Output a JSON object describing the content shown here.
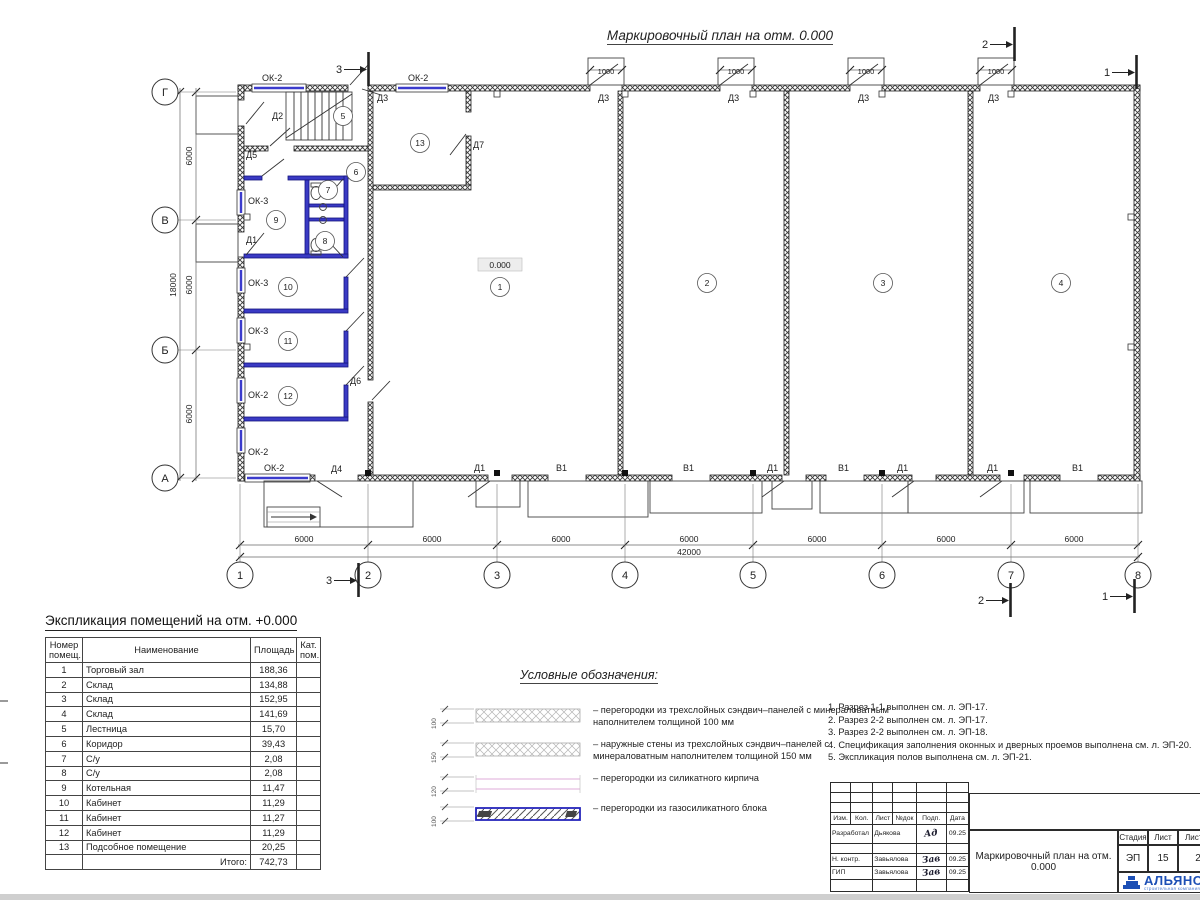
{
  "sheet": {
    "plan_title": "Маркировочный план на отм. 0.000",
    "level_mark": "0.000"
  },
  "plan": {
    "grid_rows": [
      {
        "t": "Г",
        "y": 92
      },
      {
        "t": "В",
        "y": 220
      },
      {
        "t": "Б",
        "y": 350
      },
      {
        "t": "А",
        "y": 478
      }
    ],
    "grid_cols": [
      {
        "t": "1",
        "x": 240
      },
      {
        "t": "2",
        "x": 368
      },
      {
        "t": "3",
        "x": 497
      },
      {
        "t": "4",
        "x": 625
      },
      {
        "t": "5",
        "x": 753
      },
      {
        "t": "6",
        "x": 882
      },
      {
        "t": "7",
        "x": 1011
      },
      {
        "t": "8",
        "x": 1138
      }
    ],
    "labels": [
      {
        "t": "ОК-2",
        "x": 262,
        "y": 81
      },
      {
        "t": "ОК-2",
        "x": 408,
        "y": 81
      },
      {
        "t": "Д3",
        "x": 377,
        "y": 101
      },
      {
        "t": "Д3",
        "x": 598,
        "y": 101
      },
      {
        "t": "Д3",
        "x": 728,
        "y": 101
      },
      {
        "t": "Д3",
        "x": 858,
        "y": 101
      },
      {
        "t": "Д3",
        "x": 988,
        "y": 101
      },
      {
        "t": "1000",
        "x": 606,
        "y": 74,
        "fs": 7.5,
        "a": "middle"
      },
      {
        "t": "1000",
        "x": 736,
        "y": 74,
        "fs": 7.5,
        "a": "middle"
      },
      {
        "t": "1000",
        "x": 866,
        "y": 74,
        "fs": 7.5,
        "a": "middle"
      },
      {
        "t": "1000",
        "x": 996,
        "y": 74,
        "fs": 7.5,
        "a": "middle"
      },
      {
        "t": "Д2",
        "x": 272,
        "y": 119
      },
      {
        "t": "Д5",
        "x": 246,
        "y": 158
      },
      {
        "t": "Д7",
        "x": 473,
        "y": 148
      },
      {
        "t": "Д1",
        "x": 246,
        "y": 243
      },
      {
        "t": "Д6",
        "x": 350,
        "y": 384
      },
      {
        "t": "Д4",
        "x": 331,
        "y": 472
      },
      {
        "t": "ОК-3",
        "x": 248,
        "y": 204
      },
      {
        "t": "ОК-3",
        "x": 248,
        "y": 286
      },
      {
        "t": "ОК-3",
        "x": 248,
        "y": 334
      },
      {
        "t": "ОК-2",
        "x": 248,
        "y": 398
      },
      {
        "t": "ОК-2",
        "x": 248,
        "y": 455
      },
      {
        "t": "ОК-2",
        "x": 264,
        "y": 471
      },
      {
        "t": "Д1",
        "x": 474,
        "y": 471
      },
      {
        "t": "В1",
        "x": 556,
        "y": 471
      },
      {
        "t": "В1",
        "x": 683,
        "y": 471
      },
      {
        "t": "Д1",
        "x": 767,
        "y": 471
      },
      {
        "t": "В1",
        "x": 838,
        "y": 471
      },
      {
        "t": "Д1",
        "x": 897,
        "y": 471
      },
      {
        "t": "Д1",
        "x": 987,
        "y": 471
      },
      {
        "t": "В1",
        "x": 1072,
        "y": 471
      },
      {
        "t": "6000",
        "x": 304,
        "y": 542,
        "fs": 8.5,
        "a": "middle"
      },
      {
        "t": "6000",
        "x": 432,
        "y": 542,
        "fs": 8.5,
        "a": "middle"
      },
      {
        "t": "6000",
        "x": 561,
        "y": 542,
        "fs": 8.5,
        "a": "middle"
      },
      {
        "t": "6000",
        "x": 689,
        "y": 542,
        "fs": 8.5,
        "a": "middle"
      },
      {
        "t": "6000",
        "x": 817,
        "y": 542,
        "fs": 8.5,
        "a": "middle"
      },
      {
        "t": "6000",
        "x": 946,
        "y": 542,
        "fs": 8.5,
        "a": "middle"
      },
      {
        "t": "6000",
        "x": 1074,
        "y": 542,
        "fs": 8.5,
        "a": "middle"
      },
      {
        "t": "42000",
        "x": 689,
        "y": 555,
        "fs": 8.5,
        "a": "middle"
      },
      {
        "t": "6000",
        "x": 192,
        "y": 156,
        "fs": 8.5,
        "a": "middle",
        "rot": -90
      },
      {
        "t": "6000",
        "x": 192,
        "y": 285,
        "fs": 8.5,
        "a": "middle",
        "rot": -90
      },
      {
        "t": "6000",
        "x": 192,
        "y": 414,
        "fs": 8.5,
        "a": "middle",
        "rot": -90
      },
      {
        "t": "18000",
        "x": 176,
        "y": 285,
        "fs": 8.5,
        "a": "middle",
        "rot": -90
      },
      {
        "t": "0.000",
        "x": 500,
        "y": 268,
        "fs": 8.5,
        "a": "middle"
      }
    ],
    "rooms": [
      {
        "n": "1",
        "x": 500,
        "y": 287
      },
      {
        "n": "2",
        "x": 707,
        "y": 283
      },
      {
        "n": "3",
        "x": 883,
        "y": 283
      },
      {
        "n": "4",
        "x": 1061,
        "y": 283
      },
      {
        "n": "5",
        "x": 343,
        "y": 116
      },
      {
        "n": "6",
        "x": 356,
        "y": 172
      },
      {
        "n": "7",
        "x": 328,
        "y": 190
      },
      {
        "n": "8",
        "x": 325,
        "y": 241
      },
      {
        "n": "9",
        "x": 276,
        "y": 220
      },
      {
        "n": "10",
        "x": 288,
        "y": 287
      },
      {
        "n": "11",
        "x": 288,
        "y": 341
      },
      {
        "n": "12",
        "x": 288,
        "y": 396
      },
      {
        "n": "13",
        "x": 420,
        "y": 143
      }
    ],
    "sections": [
      {
        "n": "3",
        "x": 336,
        "y": 73
      },
      {
        "n": "2",
        "x": 982,
        "y": 48
      },
      {
        "n": "1",
        "x": 1104,
        "y": 76
      },
      {
        "n": "3",
        "x": 326,
        "y": 584
      },
      {
        "n": "2",
        "x": 978,
        "y": 604
      },
      {
        "n": "1",
        "x": 1102,
        "y": 600
      }
    ]
  },
  "table": {
    "title": "Экспликация помещений на отм. +0.000",
    "headers": [
      "Номер помещ.",
      "Наименование",
      "Площадь",
      "Кат. пом."
    ],
    "rows": [
      [
        "1",
        "Торговый зал",
        "188,36"
      ],
      [
        "2",
        "Склад",
        "134,88"
      ],
      [
        "3",
        "Склад",
        "152,95"
      ],
      [
        "4",
        "Склад",
        "141,69"
      ],
      [
        "5",
        "Лестница",
        "15,70"
      ],
      [
        "6",
        "Коридор",
        "39,43"
      ],
      [
        "7",
        "С/у",
        "2,08"
      ],
      [
        "8",
        "С/у",
        "2,08"
      ],
      [
        "9",
        "Котельная",
        "11,47"
      ],
      [
        "10",
        "Кабинет",
        "11,29"
      ],
      [
        "11",
        "Кабинет",
        "11,27"
      ],
      [
        "12",
        "Кабинет",
        "11,29"
      ],
      [
        "13",
        "Подсобное помещение",
        "20,25"
      ]
    ],
    "total_label": "Итого:",
    "total_value": "742,73"
  },
  "legend": {
    "title": "Условные обозначения:",
    "items": [
      {
        "dim": "100",
        "type": "sandwich",
        "text": "– перегородки из трехслойных сэндвич–панелей с минераловатным наполнителем толщиной 100 мм"
      },
      {
        "dim": "150",
        "type": "sandwich",
        "text": "– наружные стены из трехслойных сэндвич–панелей с минераловатным наполнителем толщиной 150 мм"
      },
      {
        "dim": "120",
        "type": "brick",
        "text": "– перегородки из силикатного кирпича"
      },
      {
        "dim": "100",
        "type": "gasblock",
        "text": "– перегородки из газосиликатного блока"
      }
    ]
  },
  "notes": [
    "1. Разрез 1-1 выполнен см. л. ЭП-17.",
    "2. Разрез 2-2 выполнен см. л. ЭП-17.",
    "3. Разрез 2-2 выполнен см. л. ЭП-18.",
    "4. Спецификация заполнения оконных и дверных проемов выполнена см. л. ЭП-20.",
    "5. Экспликация полов выполнена см. л. ЭП-21."
  ],
  "titleblock": {
    "headers": [
      "Изм.",
      "Кол.",
      "Лист",
      "№док",
      "Подп.",
      "Дата"
    ],
    "people": [
      {
        "role": "Разработал",
        "name": "Дьякова",
        "sig": "Ад",
        "date": "09.25"
      },
      {
        "role": "Н. контр.",
        "name": "Завьялова",
        "sig": "Зав",
        "date": "09.25"
      },
      {
        "role": "ГИП",
        "name": "Завьялова",
        "sig": "Зав",
        "date": "09.25"
      }
    ],
    "doc_title": "Маркировочный план на отм. 0.000",
    "stage_headers": [
      "Стадия",
      "Лист",
      "Листов"
    ],
    "stage_values": [
      "ЭП",
      "15",
      "2"
    ],
    "logo_name": "АЛЬЯНС",
    "logo_sub": "строительная компания"
  }
}
